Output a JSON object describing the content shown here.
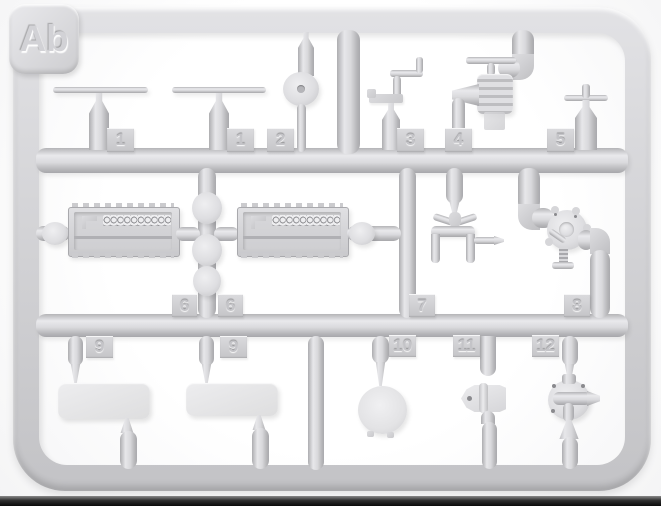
{
  "sprue": {
    "corner_label": "Ab",
    "tabs": [
      "1",
      "1",
      "2",
      "3",
      "4",
      "5",
      "6",
      "6",
      "7",
      "8",
      "9",
      "9",
      "10",
      "11",
      "12"
    ],
    "colors": {
      "plastic": "#d4d4d7",
      "plastic_highlight": "#ebebed",
      "plastic_shadow": "#a9a9ad",
      "background": "#ffffff",
      "bottom_strip": "#0a0a0a"
    },
    "parts": [
      {
        "number": "1",
        "shape": "thin-rod-on-post"
      },
      {
        "number": "1",
        "shape": "thin-rod-on-post"
      },
      {
        "number": "2",
        "shape": "pulley-disc"
      },
      {
        "number": "3",
        "shape": "crank-bracket"
      },
      {
        "number": "4",
        "shape": "valve-with-t-handle"
      },
      {
        "number": "5",
        "shape": "bottle-with-cross-handle"
      },
      {
        "number": "6",
        "shape": "open-ammo-box"
      },
      {
        "number": "6",
        "shape": "open-ammo-box"
      },
      {
        "number": "7",
        "shape": "fork-yoke"
      },
      {
        "number": "8",
        "shape": "round-pump-flange"
      },
      {
        "number": "9",
        "shape": "flat-rectangular-plate"
      },
      {
        "number": "9",
        "shape": "flat-rectangular-plate"
      },
      {
        "number": "10",
        "shape": "round-disc-lid"
      },
      {
        "number": "11",
        "shape": "shield-plate"
      },
      {
        "number": "12",
        "shape": "round-pump-valve"
      }
    ]
  }
}
